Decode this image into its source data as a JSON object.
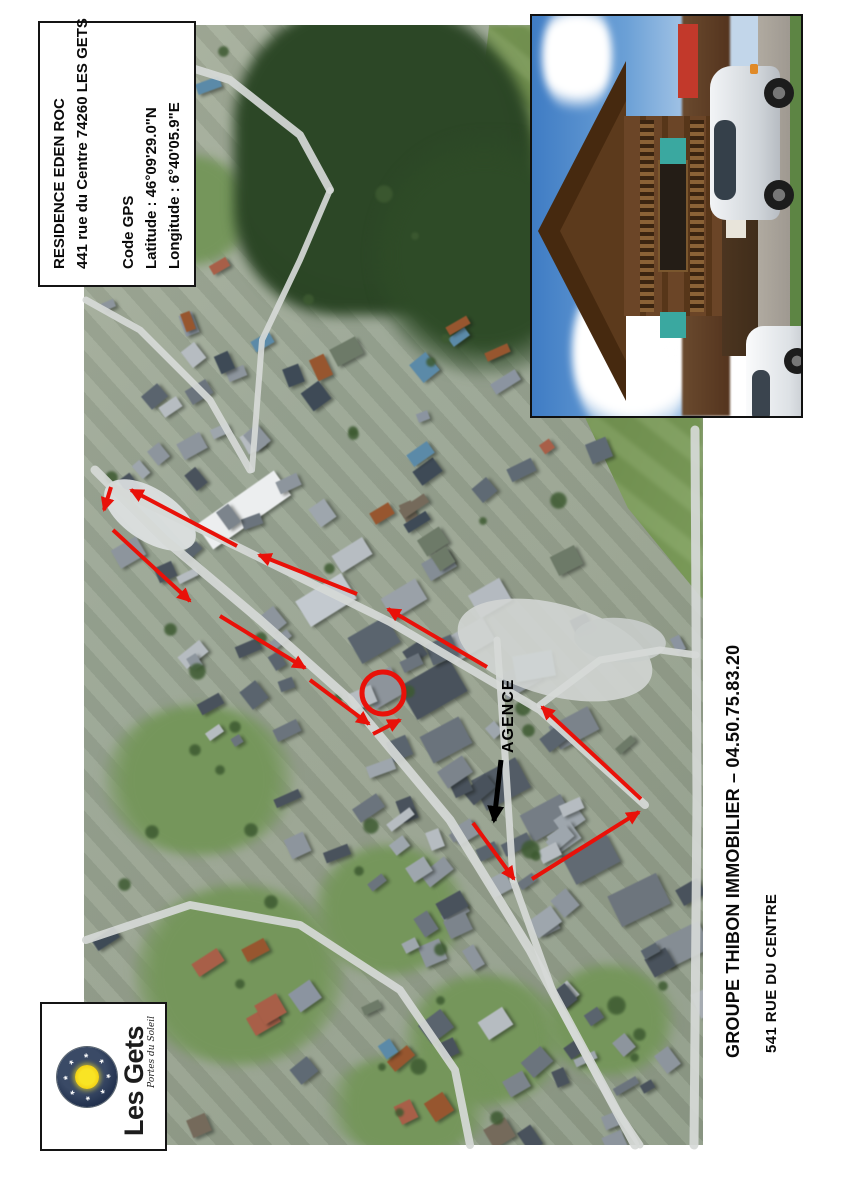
{
  "info_box": {
    "title": "RESIDENCE EDEN ROC",
    "address": "441 rue du Centre 74260 LES GETS",
    "gps_heading": "Code GPS",
    "latitude": "Latitude : 46°09'29.0\"N",
    "longitude": "Longitude : 6°40'05.9\"E"
  },
  "map_annotations": {
    "agency_label": "AGENCE",
    "route_color": "#e91109",
    "agency_arrow_color": "#000000",
    "marker_circle": {
      "cx": 383,
      "cy": 693,
      "r": 21
    },
    "agency_arrow": {
      "x1": 501,
      "y1": 760,
      "x2": 494,
      "y2": 821
    },
    "route_arrows": [
      [
        111,
        487,
        104,
        510
      ],
      [
        237,
        546,
        131,
        490
      ],
      [
        113,
        530,
        190,
        601
      ],
      [
        357,
        594,
        259,
        555
      ],
      [
        220,
        616,
        305,
        668
      ],
      [
        487,
        667,
        388,
        609
      ],
      [
        310,
        680,
        369,
        724
      ],
      [
        373,
        734,
        400,
        720
      ],
      [
        473,
        823,
        514,
        879
      ],
      [
        532,
        879,
        639,
        812
      ],
      [
        641,
        799,
        542,
        707
      ]
    ]
  },
  "footer": {
    "company_line": "GROUPE THIBON IMMOBILIER – 04.50.75.83.20",
    "address_line": "541 RUE DU CENTRE"
  },
  "logo": {
    "title": "Les Gets",
    "tagline": "Portes du Soleil"
  }
}
